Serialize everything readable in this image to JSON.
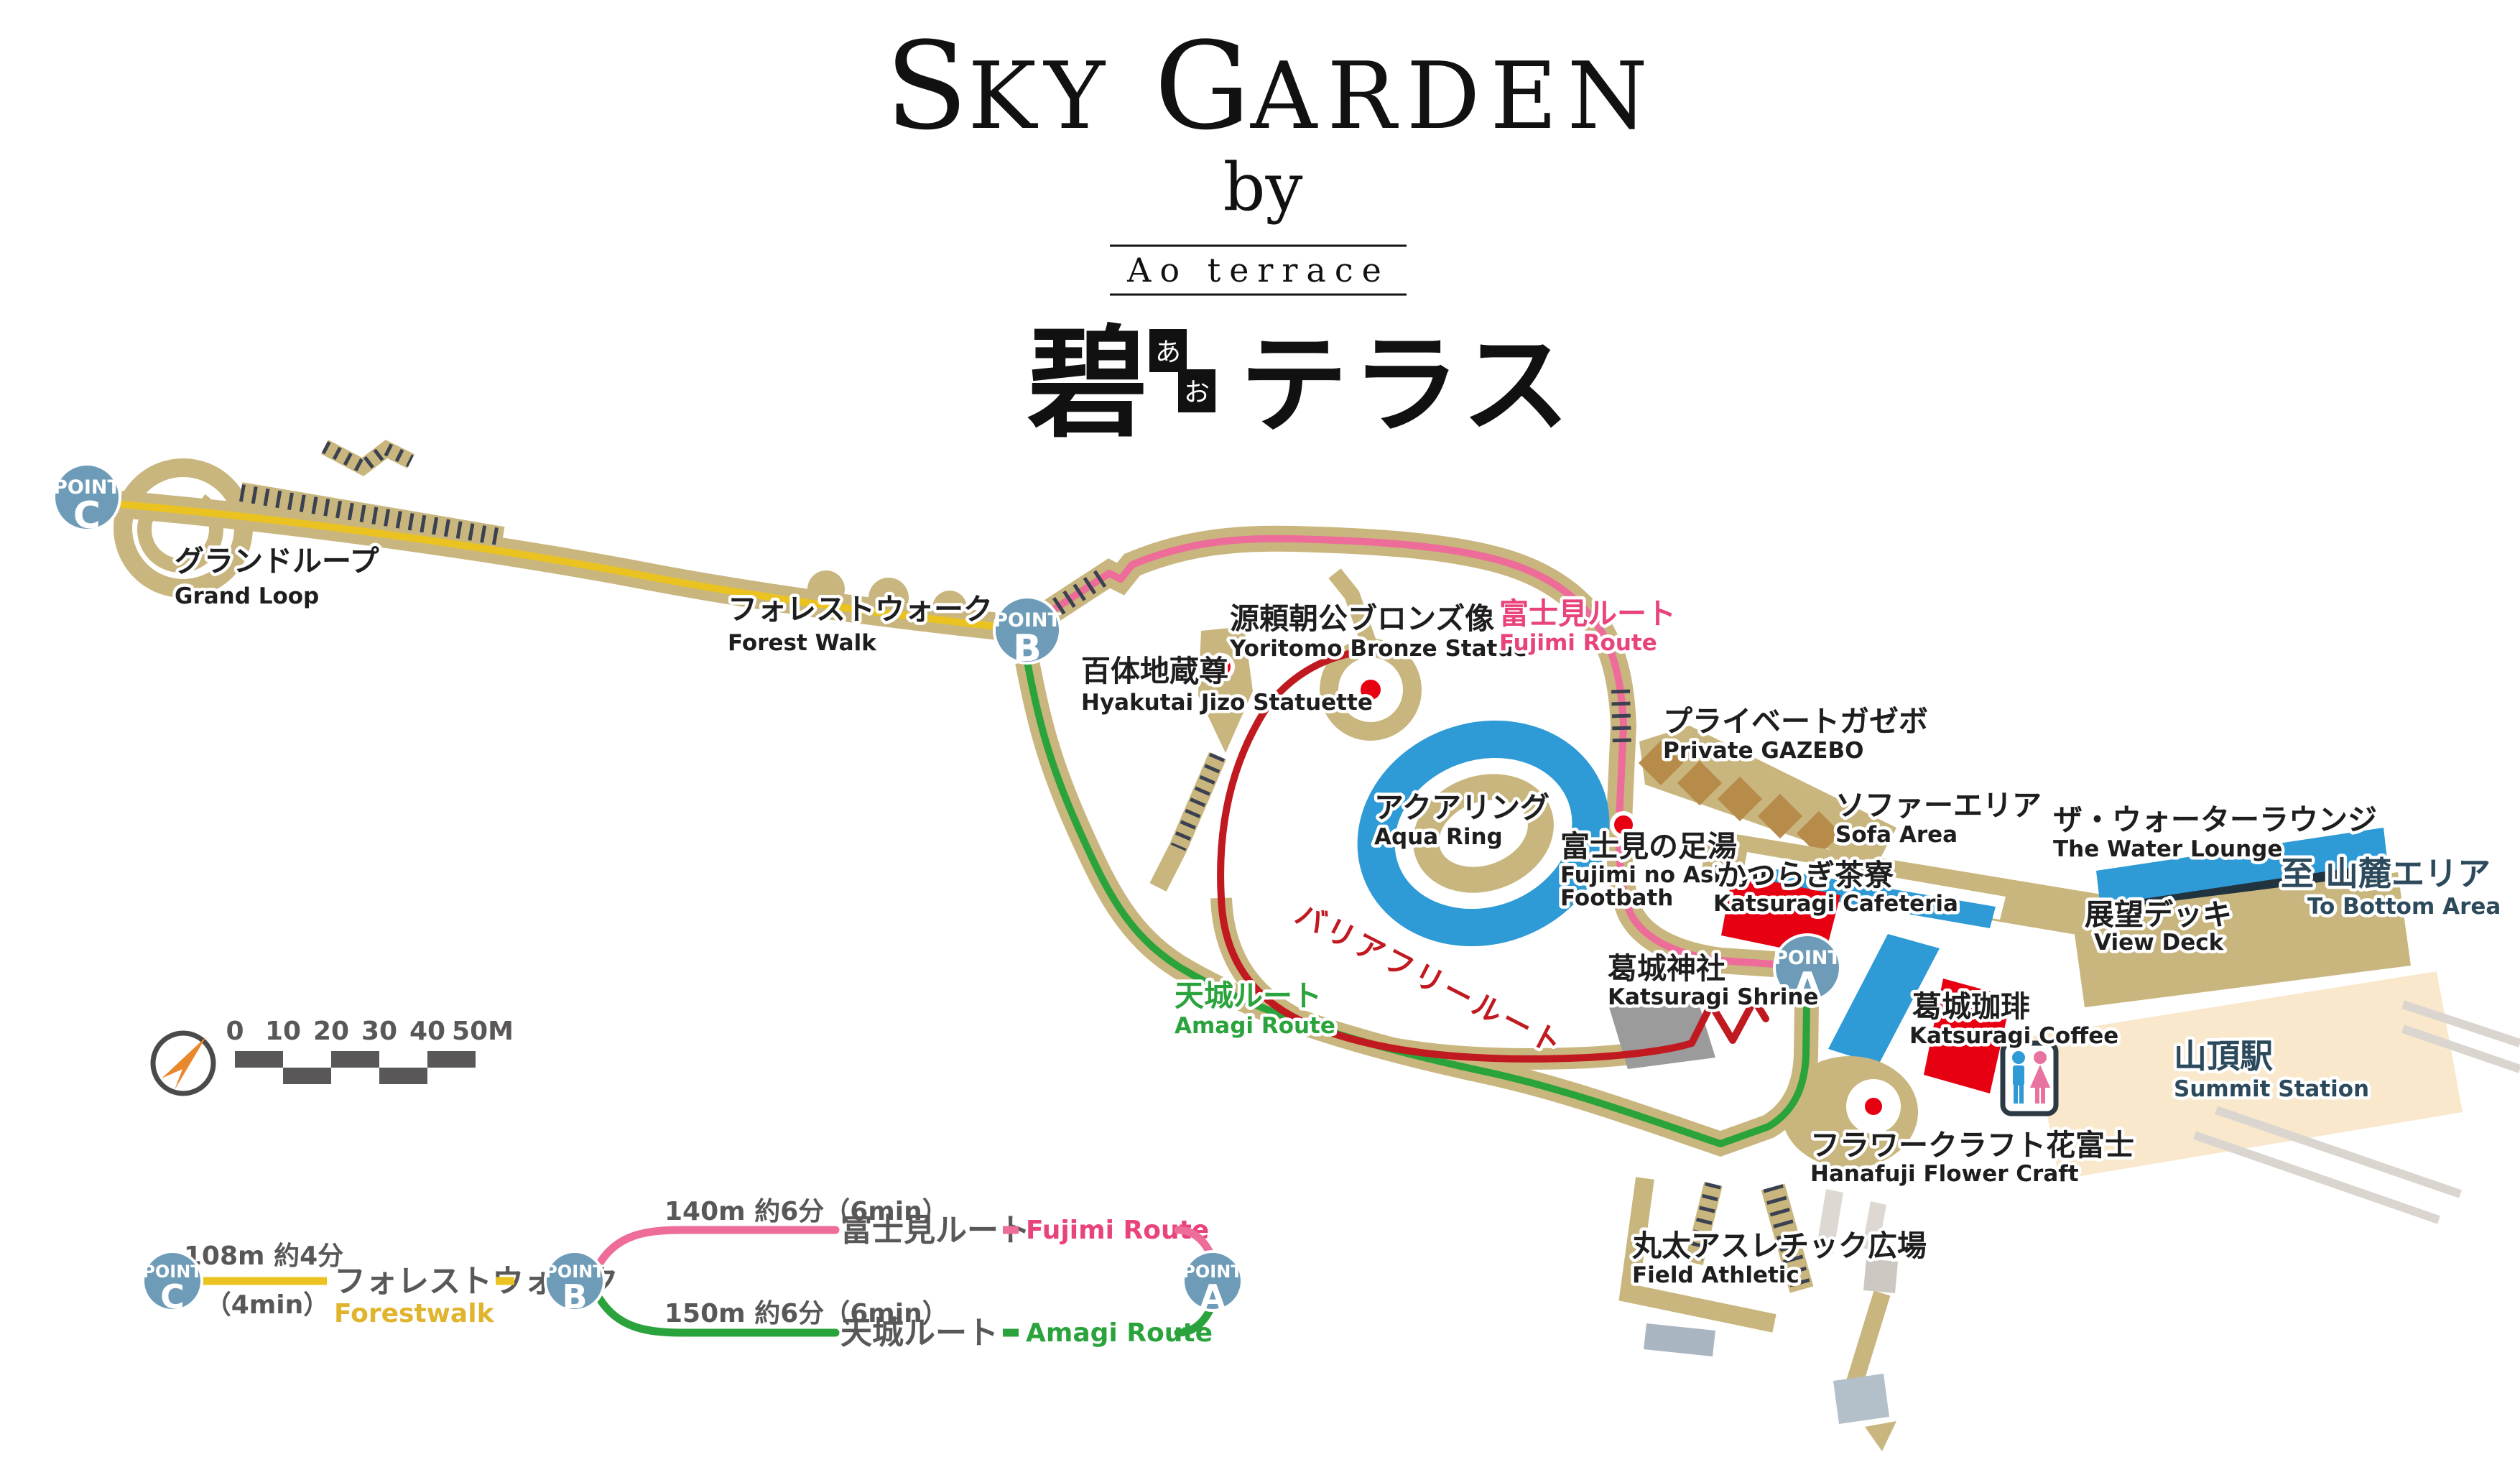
{
  "header": {
    "title_parts": [
      "S",
      "KY ",
      "G",
      "ARDEN"
    ],
    "by": "by",
    "brand": "Ao terrace",
    "jp_kanji": "碧",
    "furigana": [
      "あ",
      "お"
    ],
    "jp_kana": "テラス"
  },
  "points": {
    "word": "POINT",
    "a": "A",
    "b": "B",
    "c": "C"
  },
  "map": {
    "labels": {
      "grand_loop": {
        "ja": "グランドループ",
        "en": "Grand Loop"
      },
      "forest_walk": {
        "ja": "フォレストウォーク",
        "en": "Forest Walk"
      },
      "hyakutai_jizo": {
        "ja": "百体地蔵尊",
        "en": "Hyakutai Jizo Statuette"
      },
      "yoritomo": {
        "ja": "源頼朝公ブロンズ像",
        "en": "Yoritomo Bronze Statue"
      },
      "fujimi_route": {
        "ja": "富士見ルート",
        "en": "Fujimi Route"
      },
      "private_gazebo": {
        "ja": "プライベートガゼボ",
        "en": "Private GAZEBO"
      },
      "sofa_area": {
        "ja": "ソファーエリア",
        "en": "Sofa Area"
      },
      "water_lounge": {
        "ja": "ザ・ウォーターラウンジ",
        "en": "The Water Lounge"
      },
      "view_deck": {
        "ja": "展望デッキ",
        "en": "View Deck"
      },
      "to_bottom_area": {
        "ja": "至 山麓エリア",
        "en": "To Bottom Area"
      },
      "aqua_ring": {
        "ja": "アクアリング",
        "en": "Aqua Ring"
      },
      "fujimi_ashiyu": {
        "ja": "富士見の足湯",
        "en1": "Fujimi no Ashiyu",
        "en2": "Footbath"
      },
      "katsuragi_cafeteria": {
        "ja": "かつらぎ茶寮",
        "en": "Katsuragi Cafeteria"
      },
      "amagi_route": {
        "ja": "天城ルート",
        "en": "Amagi Route"
      },
      "barrier_free": {
        "ja": "バリアフリールート"
      },
      "katsuragi_shrine": {
        "ja": "葛城神社",
        "en": "Katsuragi Shrine"
      },
      "katsuragi_coffee": {
        "ja": "葛城珈琲",
        "en": "Katsuragi Coffee"
      },
      "summit_station": {
        "ja": "山頂駅",
        "en": "Summit Station"
      },
      "hanafuji": {
        "ja": "フラワークラフト花富士",
        "en": "Hanafuji Flower Craft"
      },
      "field_athletic": {
        "ja": "丸太アスレチック広場",
        "en": "Field Athletic"
      }
    },
    "scale_ticks": [
      "0",
      "10",
      "20",
      "30",
      "40",
      "50M"
    ]
  },
  "route_diagram": {
    "forestwalk": {
      "distance": "108m 約4分",
      "minutes": "（4min）",
      "ja": "フォレストウォーク",
      "en": "Forestwalk"
    },
    "fujimi": {
      "distance": "140m 約6分（6min）",
      "ja": "富士見ルート",
      "en": "Fujimi Route"
    },
    "amagi": {
      "distance": "150m 約6分（6min）",
      "ja": "天城ルート",
      "en": "Amagi Route"
    }
  },
  "colors": {
    "walkway_tan": "#C9B67E",
    "stair_hatch": "#3A4150",
    "forest_yellow": "#EBC321",
    "fujimi_pink": "#ED6C99",
    "fujimi_label_pink": "#E8437C",
    "amagi_green": "#2BA33C",
    "barrier_free_red": "#C11920",
    "marker_red": "#E60012",
    "water_blue": "#2E9AD6",
    "lounge_navy": "#21333F",
    "point_blue": "#6E9CB8",
    "station_beige": "#FAE8CC",
    "shrine_gray": "#9B9B9B",
    "compass_orange": "#E8872B",
    "text_gray": "#595757",
    "text_slate": "#2C4A5C"
  }
}
